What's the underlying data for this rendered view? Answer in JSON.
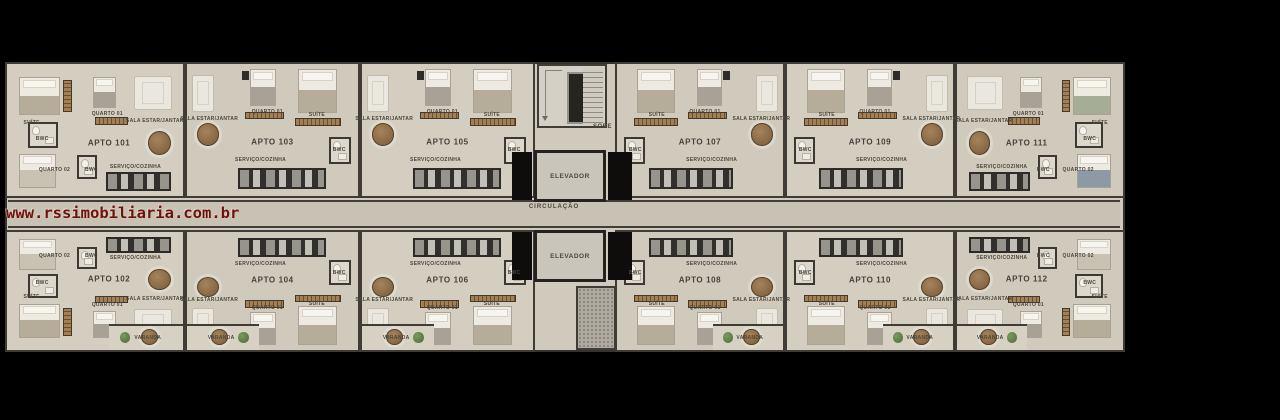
{
  "watermark": "www.rssimobiliaria.com.br",
  "core": {
    "stairs_label": "SOBE",
    "elevator_top": "ELEVADOR",
    "elevator_bottom": "ELEVADOR",
    "corridor_label": "CIRCULAÇÃO"
  },
  "units": [
    {
      "number": "APTO 101",
      "rooms": {
        "suite": "SUÍTE",
        "q1": "QUARTO 01",
        "q2": "QUARTO 02",
        "bwc": "BWC",
        "sala": "SALA ESTAR/JANTAR",
        "cozinha": "SERVIÇO/COZINHA"
      }
    },
    {
      "number": "APTO 102",
      "rooms": {
        "suite": "SUÍTE",
        "q1": "QUARTO 01",
        "q2": "QUARTO 02",
        "bwc": "BWC",
        "sala": "SALA ESTAR/JANTAR",
        "cozinha": "SERVIÇO/COZINHA",
        "varanda": "VARANDA"
      }
    },
    {
      "number": "APTO 103",
      "rooms": {
        "suite": "SUÍTE",
        "q1": "QUARTO 01",
        "bwc": "BWC",
        "sala": "SALA ESTAR/JANTAR",
        "cozinha": "SERVIÇO/COZINHA"
      }
    },
    {
      "number": "APTO 104",
      "rooms": {
        "suite": "SUÍTE",
        "q1": "QUARTO 01",
        "bwc": "BWC",
        "sala": "SALA ESTAR/JANTAR",
        "cozinha": "SERVIÇO/COZINHA",
        "varanda": "VARANDA"
      }
    },
    {
      "number": "APTO 105",
      "rooms": {
        "suite": "SUÍTE",
        "q1": "QUARTO 01",
        "bwc": "BWC",
        "sala": "SALA ESTAR/JANTAR",
        "cozinha": "SERVIÇO/COZINHA"
      }
    },
    {
      "number": "APTO 106",
      "rooms": {
        "suite": "SUÍTE",
        "q1": "QUARTO 01",
        "bwc": "BWC",
        "sala": "SALA ESTAR/JANTAR",
        "cozinha": "SERVIÇO/COZINHA",
        "varanda": "VARANDA"
      }
    },
    {
      "number": "APTO 107",
      "rooms": {
        "suite": "SUÍTE",
        "q1": "QUARTO 01",
        "bwc": "BWC",
        "sala": "SALA ESTAR/JANTAR",
        "cozinha": "SERVIÇO/COZINHA"
      }
    },
    {
      "number": "APTO 108",
      "rooms": {
        "suite": "SUÍTE",
        "q1": "QUARTO 01",
        "bwc": "BWC",
        "sala": "SALA ESTAR/JANTAR",
        "cozinha": "SERVIÇO/COZINHA",
        "varanda": "VARANDA"
      }
    },
    {
      "number": "APTO 109",
      "rooms": {
        "suite": "SUÍTE",
        "q1": "QUARTO 01",
        "bwc": "BWC",
        "sala": "SALA ESTAR/JANTAR",
        "cozinha": "SERVIÇO/COZINHA"
      }
    },
    {
      "number": "APTO 110",
      "rooms": {
        "suite": "SUÍTE",
        "q1": "QUARTO 01",
        "bwc": "BWC",
        "sala": "SALA ESTAR/JANTAR",
        "cozinha": "SERVIÇO/COZINHA",
        "varanda": "VARANDA"
      }
    },
    {
      "number": "APTO 111",
      "rooms": {
        "suite": "SUÍTE",
        "q1": "QUARTO 01",
        "q2": "QUARTO 02",
        "bwc": "BWC",
        "sala": "SALA ESTAR/JANTAR",
        "cozinha": "SERVIÇO/COZINHA"
      },
      "colors": {
        "bedS": "#a6ad97",
        "bedQ2": "#8d9aa6"
      }
    },
    {
      "number": "APTO 112",
      "rooms": {
        "suite": "SUÍTE",
        "q1": "QUARTO 01",
        "q2": "QUARTO 02",
        "bwc": "BWC",
        "sala": "SALA ESTAR/JANTAR",
        "cozinha": "SERVIÇO/COZINHA",
        "varanda": "VARANDA"
      }
    }
  ]
}
